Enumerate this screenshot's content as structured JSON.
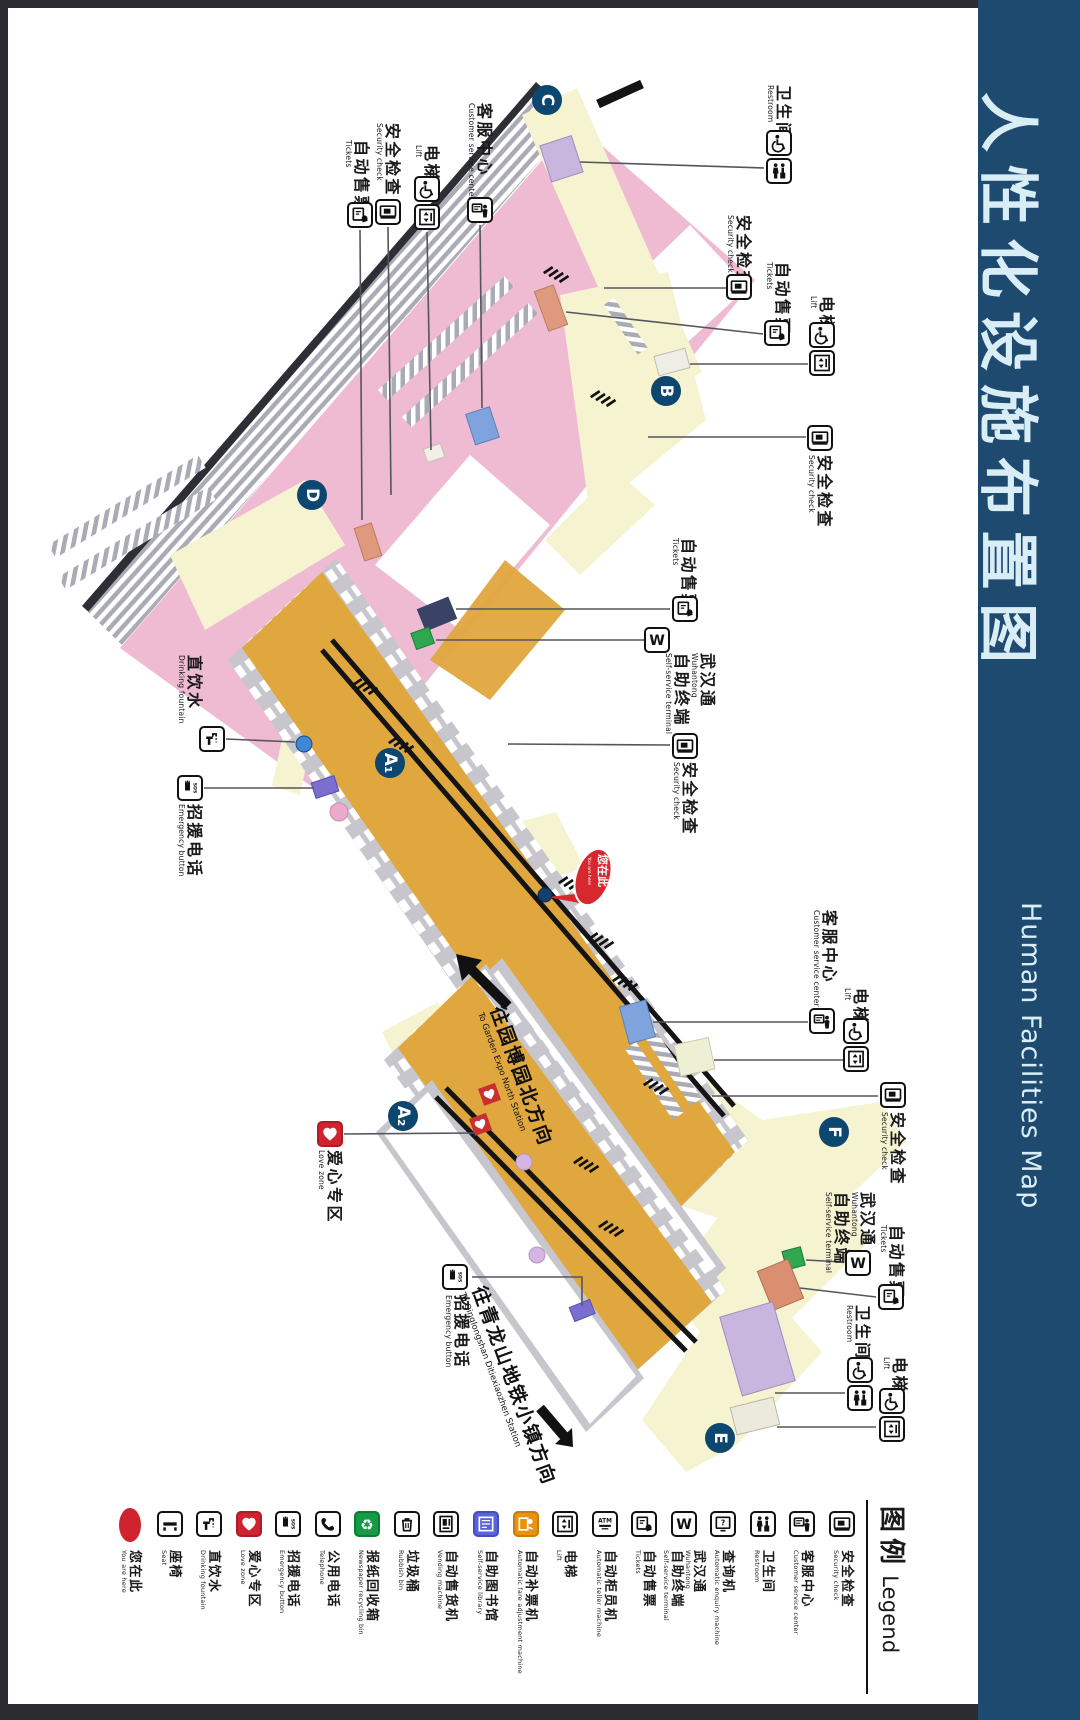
{
  "title": {
    "zh": "人性化设施布置图",
    "en": "Human Facilities Map"
  },
  "colors": {
    "titlebar": "#1d4a6e",
    "frame": "#2b2b31",
    "concourse_pink": "#eebbd3",
    "walkway_cream": "#f6f3d0",
    "platform_gold": "#e0a73e",
    "badge_navy": "#0d466e",
    "marker_red": "#d7282f"
  },
  "you_are_here": {
    "zh": "您在此",
    "en": "You are here"
  },
  "entrances": [
    {
      "label": "C",
      "x": 547,
      "y": 100
    },
    {
      "label": "B",
      "x": 666,
      "y": 391
    },
    {
      "label": "D",
      "x": 312,
      "y": 495
    },
    {
      "label": "A₁",
      "x": 390,
      "y": 763
    },
    {
      "label": "A₂",
      "x": 403,
      "y": 1116
    },
    {
      "label": "F",
      "x": 834,
      "y": 1132
    },
    {
      "label": "E",
      "x": 720,
      "y": 1438
    }
  ],
  "arrows": [
    {
      "id": "to-garden-expo",
      "zh": "往园博园北方向",
      "en": "To Garden Expo North Station",
      "tx": 510,
      "ty": 1002,
      "angle": 70
    },
    {
      "id": "to-qinglongshan",
      "zh": "往青龙山地铁小镇方向",
      "en": "To Qinglongshan Ditiexiaozhen Station",
      "tx": 492,
      "ty": 1282,
      "angle": 70
    }
  ],
  "callouts": [
    {
      "id": "tickets-c",
      "zh": "自动售票",
      "en": "Tickets",
      "icons": [
        "tvm"
      ],
      "icx": 360,
      "iy": 202,
      "tx": 370,
      "ty": 140,
      "leader": [
        [
          360,
          230
        ],
        [
          362,
          520
        ]
      ]
    },
    {
      "id": "security-c",
      "zh": "安全检查",
      "en": "Security check",
      "icons": [
        "security"
      ],
      "icx": 388,
      "iy": 199,
      "tx": 401,
      "ty": 123,
      "leader": [
        [
          388,
          227
        ],
        [
          391,
          495
        ]
      ]
    },
    {
      "id": "lift-c",
      "zh": "电梯",
      "en": "Lift",
      "icons": [
        "wheelchair",
        "lift"
      ],
      "icx": 427,
      "iy": 176,
      "tx": 440,
      "ty": 145,
      "leader": [
        [
          427,
          232
        ],
        [
          431,
          450
        ]
      ]
    },
    {
      "id": "csc-c",
      "zh": "客服中心",
      "en": "Customer service center",
      "icons": [
        "csc"
      ],
      "icx": 480,
      "iy": 197,
      "tx": 493,
      "ty": 103,
      "leader": [
        [
          480,
          225
        ],
        [
          482,
          408
        ]
      ]
    },
    {
      "id": "restroom-b",
      "zh": "卫生间",
      "en": "Restroom",
      "icons": [
        "wheelchair",
        "wc"
      ],
      "icx": 779,
      "iy": 130,
      "tx": 792,
      "ty": 85,
      "leader": [
        [
          764,
          168
        ],
        [
          580,
          162
        ]
      ]
    },
    {
      "id": "security-b1",
      "zh": "安全检查",
      "en": "Security check",
      "icons": [
        "security"
      ],
      "icx": 739,
      "iy": 274,
      "tx": 752,
      "ty": 215,
      "leader": [
        [
          726,
          288
        ],
        [
          604,
          288
        ]
      ]
    },
    {
      "id": "tickets-b",
      "zh": "自动售票",
      "en": "Tickets",
      "icons": [
        "tvm"
      ],
      "icx": 777,
      "iy": 320,
      "tx": 791,
      "ty": 262,
      "leader": [
        [
          763,
          334
        ],
        [
          566,
          312
        ]
      ]
    },
    {
      "id": "lift-b",
      "zh": "电梯",
      "en": "Lift",
      "icons": [
        "wheelchair",
        "lift"
      ],
      "icx": 822,
      "iy": 322,
      "tx": 835,
      "ty": 296,
      "leader": [
        [
          808,
          364
        ],
        [
          690,
          364
        ]
      ]
    },
    {
      "id": "security-b2",
      "zh": "安全检查",
      "en": "Security check",
      "icons": [
        "security"
      ],
      "icx": 820,
      "iy": 425,
      "tx": 833,
      "ty": 455,
      "leader": [
        [
          806,
          437
        ],
        [
          648,
          437
        ]
      ]
    },
    {
      "id": "tickets-mid",
      "zh": "自动售票",
      "en": "Tickets",
      "icons": [
        "tvm"
      ],
      "icx": 685,
      "iy": 596,
      "tx": 697,
      "ty": 538,
      "leader": [
        [
          670,
          609
        ],
        [
          456,
          609
        ]
      ]
    },
    {
      "id": "wuhantong-mid",
      "zh": "武汉通",
      "en": "Wuhantong",
      "zh2": "自助终端",
      "en2": "Self-service terminal",
      "icons": [
        "w"
      ],
      "icx": 657,
      "iy": 627,
      "tx": 716,
      "ty": 653,
      "leader": [
        [
          644,
          640
        ],
        [
          436,
          640
        ]
      ]
    },
    {
      "id": "security-mid",
      "zh": "安全检查",
      "en": "Security check",
      "icons": [
        "security"
      ],
      "icx": 685,
      "iy": 733,
      "tx": 698,
      "ty": 762,
      "leader": [
        [
          670,
          745
        ],
        [
          508,
          744
        ]
      ]
    },
    {
      "id": "fountain-a1",
      "zh": "直饮水",
      "en": "Drinking fountain",
      "icons": [
        "faucet"
      ],
      "icx": 212,
      "iy": 726,
      "tx": 203,
      "ty": 655,
      "leader": [
        [
          226,
          739
        ],
        [
          295,
          742
        ]
      ]
    },
    {
      "id": "sos-a1",
      "zh": "招援电话",
      "en": "Emergency button",
      "icons": [
        "sos"
      ],
      "icx": 190,
      "iy": 775,
      "tx": 203,
      "ty": 804,
      "leader": [
        [
          204,
          788
        ],
        [
          314,
          788
        ]
      ]
    },
    {
      "id": "lovezone-a2",
      "zh": "爱心专区",
      "en": "Love zone",
      "icons": [
        "heart"
      ],
      "icx": 330,
      "iy": 1121,
      "tx": 343,
      "ty": 1150,
      "leader": [
        [
          344,
          1134
        ],
        [
          476,
          1133
        ]
      ]
    },
    {
      "id": "sos-a2",
      "zh": "招援电话",
      "en": "Emergency button",
      "icons": [
        "sos"
      ],
      "icx": 455,
      "iy": 1264,
      "tx": 470,
      "ty": 1295,
      "leader": [
        [
          472,
          1277
        ],
        [
          582,
          1277
        ],
        [
          582,
          1306
        ]
      ]
    },
    {
      "id": "csc-f",
      "zh": "客服中心",
      "en": "Customer service center",
      "icons": [
        "csc"
      ],
      "icx": 822,
      "iy": 1008,
      "tx": 838,
      "ty": 910,
      "leader": [
        [
          808,
          1022
        ],
        [
          653,
          1022
        ]
      ]
    },
    {
      "id": "lift-f",
      "zh": "电梯",
      "en": "Lift",
      "icons": [
        "wheelchair",
        "lift"
      ],
      "icx": 856,
      "iy": 1018,
      "tx": 869,
      "ty": 988,
      "leader": [
        [
          843,
          1060
        ],
        [
          714,
          1060
        ]
      ]
    },
    {
      "id": "security-f",
      "zh": "安全检查",
      "en": "Security check",
      "icons": [
        "security"
      ],
      "icx": 893,
      "iy": 1082,
      "tx": 906,
      "ty": 1112,
      "leader": [
        [
          878,
          1096
        ],
        [
          712,
          1096
        ]
      ]
    },
    {
      "id": "wuhantong-e",
      "zh": "武汉通",
      "en": "Wuhantong",
      "zh2": "自助终端",
      "en2": "Self-service terminal",
      "icons": [
        "w"
      ],
      "icx": 858,
      "iy": 1250,
      "tx": 876,
      "ty": 1192,
      "leader": [
        [
          843,
          1262
        ],
        [
          806,
          1260
        ]
      ]
    },
    {
      "id": "tickets-e",
      "zh": "自动售票",
      "en": "Tickets",
      "icons": [
        "tvm"
      ],
      "icx": 891,
      "iy": 1284,
      "tx": 905,
      "ty": 1225,
      "leader": [
        [
          876,
          1297
        ],
        [
          800,
          1288
        ]
      ]
    },
    {
      "id": "restroom-e",
      "zh": "卫生间",
      "en": "Restroom",
      "icons": [
        "wheelchair",
        "wc"
      ],
      "icx": 860,
      "iy": 1357,
      "tx": 871,
      "ty": 1305,
      "leader": [
        [
          845,
          1393
        ],
        [
          775,
          1393
        ]
      ]
    },
    {
      "id": "lift-e",
      "zh": "电梯",
      "en": "Lift",
      "icons": [
        "wheelchair",
        "lift"
      ],
      "icx": 892,
      "iy": 1388,
      "tx": 908,
      "ty": 1357,
      "leader": [
        [
          876,
          1427
        ],
        [
          777,
          1427
        ]
      ]
    }
  ],
  "legend": {
    "header_zh": "图例",
    "header_en": "Legend",
    "items": [
      {
        "icon": "youarehere",
        "zh": "您在此",
        "en": "You are here",
        "style": "oval"
      },
      {
        "icon": "seat",
        "zh": "座椅",
        "en": "Seat"
      },
      {
        "icon": "faucet",
        "zh": "直饮水",
        "en": "Drinking fountain"
      },
      {
        "icon": "heart",
        "zh": "爱心专区",
        "en": "Love zone",
        "style": "red"
      },
      {
        "icon": "sos",
        "zh": "招援电话",
        "en": "Emergency button"
      },
      {
        "icon": "phone",
        "zh": "公用电话",
        "en": "Telephone"
      },
      {
        "icon": "recycle",
        "zh": "报纸回收箱",
        "en": "Newspaper recycling bin",
        "style": "green"
      },
      {
        "icon": "bin",
        "zh": "垃圾桶",
        "en": "Rubbish bin"
      },
      {
        "icon": "vending",
        "zh": "自动售货机",
        "en": "Vending machine"
      },
      {
        "icon": "library",
        "zh": "自助图书馆",
        "en": "Self-service library",
        "style": "blue"
      },
      {
        "icon": "fareadj",
        "zh": "自动补票机",
        "en": "Automatic fare adjustment machine",
        "style": "orange"
      },
      {
        "icon": "lift",
        "zh": "电梯",
        "en": "Lift"
      },
      {
        "icon": "atm",
        "zh": "自动柜员机",
        "en": "Automatic teller machine"
      },
      {
        "icon": "tvm",
        "zh": "自动售票",
        "en": "Tickets"
      },
      {
        "icon": "w",
        "zh": "武汉通",
        "en": "Wuhantong",
        "zh2": "自助终端",
        "en2": "Self-service terminal"
      },
      {
        "icon": "enquiry",
        "zh": "查询机",
        "en": "Automatic enquiry machine"
      },
      {
        "icon": "wc",
        "zh": "卫生间",
        "en": "Restroom"
      },
      {
        "icon": "csc",
        "zh": "客服中心",
        "en": "Customer service center"
      },
      {
        "icon": "security",
        "zh": "安全检查",
        "en": "Security check"
      }
    ]
  }
}
